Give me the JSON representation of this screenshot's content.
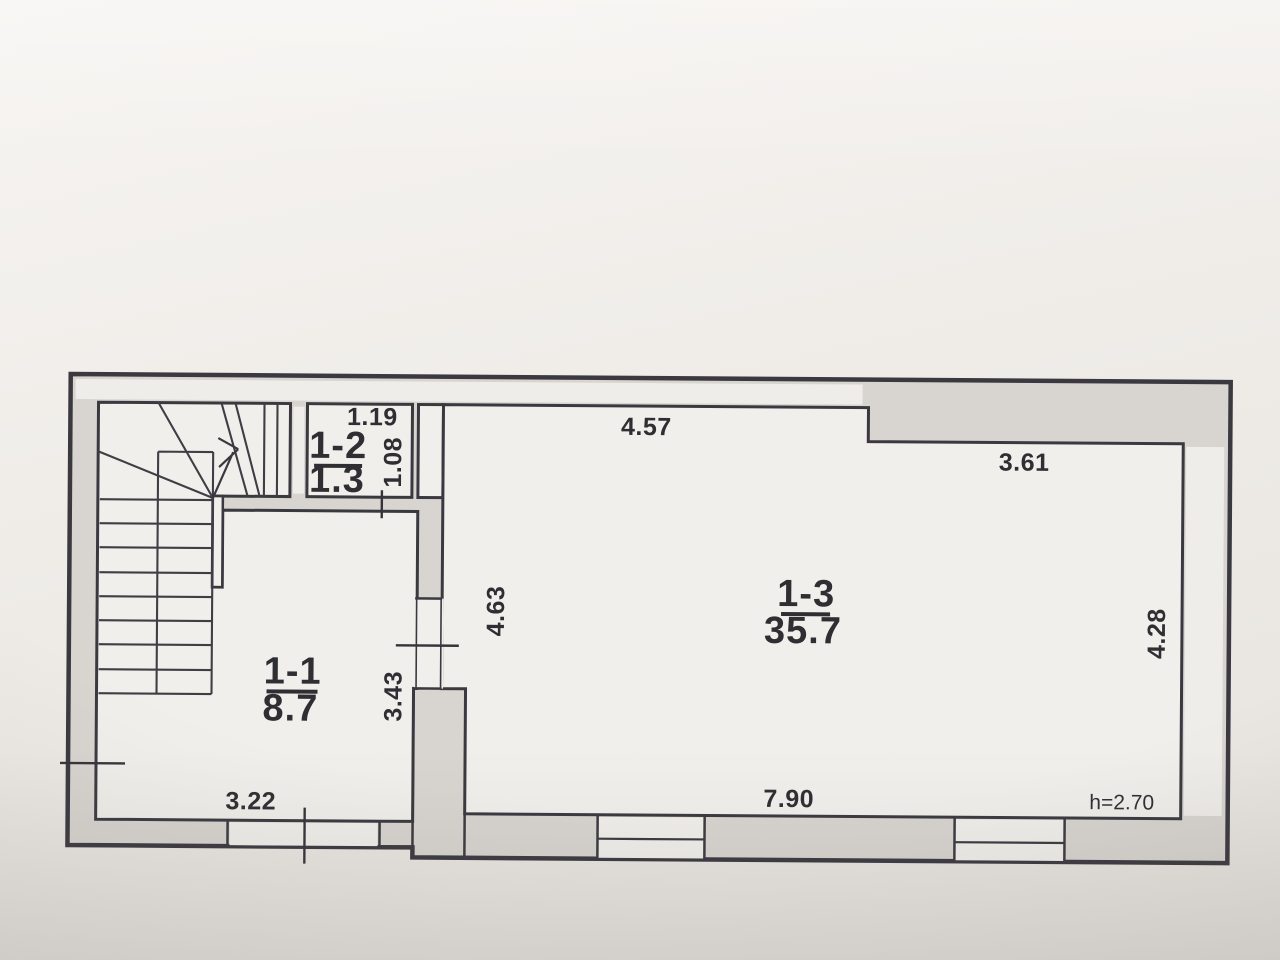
{
  "plan": {
    "rooms": [
      {
        "id": "1-1",
        "area": "8.7"
      },
      {
        "id": "1-2",
        "area": "1.3"
      },
      {
        "id": "1-3",
        "area": "35.7"
      }
    ],
    "dimensions": {
      "room2_width": "1.19",
      "room2_depth": "1.08",
      "room3_top_left": "4.57",
      "room3_top_right": "3.61",
      "room3_left": "4.63",
      "room3_right": "4.28",
      "partition_wall": "3.43",
      "room1_bottom": "3.22",
      "room3_bottom": "7.90"
    },
    "notes": {
      "ceiling_height": "h=2.70"
    },
    "colors": {
      "line": "#3a3940",
      "wall_fill": "#d8d4cf",
      "paper": "#f1efeb"
    }
  }
}
